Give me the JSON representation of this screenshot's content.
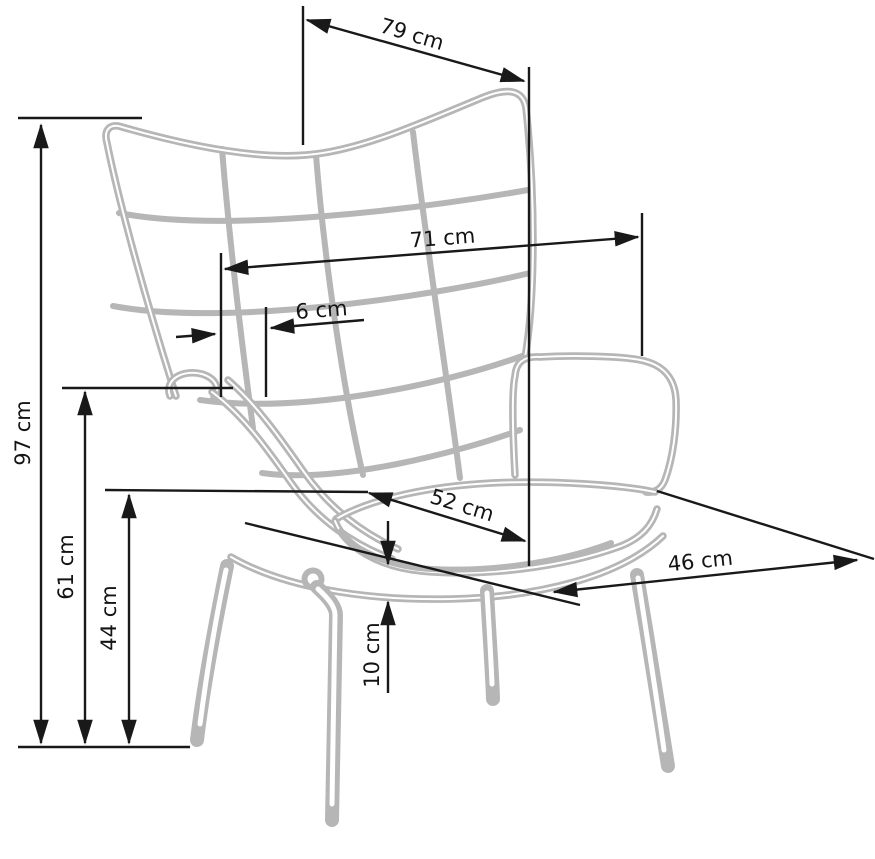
{
  "figure": {
    "type": "furniture-dimension-diagram",
    "subject": "wingback quilted armchair, three-quarter line drawing",
    "unit": "cm",
    "colors": {
      "background": "#ffffff",
      "chair_outline": "#b6b6b6",
      "dimension_lines": "#191919",
      "label_text": "#141414"
    }
  },
  "dimensions": {
    "d79": {
      "label": "79 cm",
      "value": 79
    },
    "d71": {
      "label": "71 cm",
      "value": 71
    },
    "d6": {
      "label": "6 cm",
      "value": 6
    },
    "d52": {
      "label": "52 cm",
      "value": 52
    },
    "d46": {
      "label": "46 cm",
      "value": 46
    },
    "d97": {
      "label": "97 cm",
      "value": 97
    },
    "d61": {
      "label": "61 cm",
      "value": 61
    },
    "d44": {
      "label": "44 cm",
      "value": 44
    },
    "d10": {
      "label": "10 cm",
      "value": 10
    }
  }
}
